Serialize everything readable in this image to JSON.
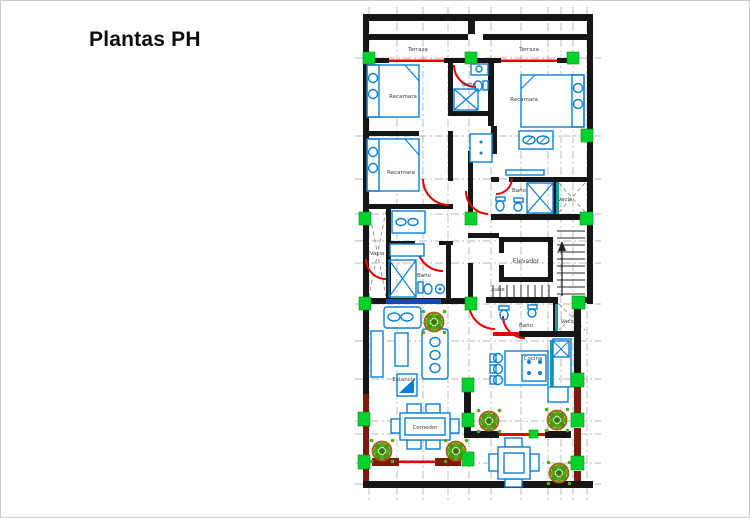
{
  "page": {
    "title": "Plantas PH"
  },
  "colors": {
    "wall": "#161616",
    "terrace_wall": "#7d1a0b",
    "furniture_blue": "#0b7fd4",
    "door_red": "#e60000",
    "column_green": "#00d22d",
    "plant_green": "#59a81c",
    "plant_ring": "#bf5110",
    "grid_gray": "#939393",
    "teal_accent": "#0f9fa4"
  },
  "plan": {
    "labels": {
      "terraza_left": "Terraza",
      "terraza_right": "Terraza",
      "recamara_top_left": "Recamara",
      "recamara_mid_left": "Recamara",
      "recamara_top_right": "Recamara",
      "bano_top": "Baño",
      "bano_right": "Baño",
      "bano_lower_left": "Baño",
      "bano_lower_right": "Baño",
      "vacio_left": "Vacío",
      "vacio_right_upper": "Vacío",
      "vacio_right_lower": "Vacío",
      "elevador": "Elevador",
      "sube": "sube",
      "estancia": "Estancia",
      "cocina": "Cocina",
      "comedor": "Comedor"
    }
  }
}
